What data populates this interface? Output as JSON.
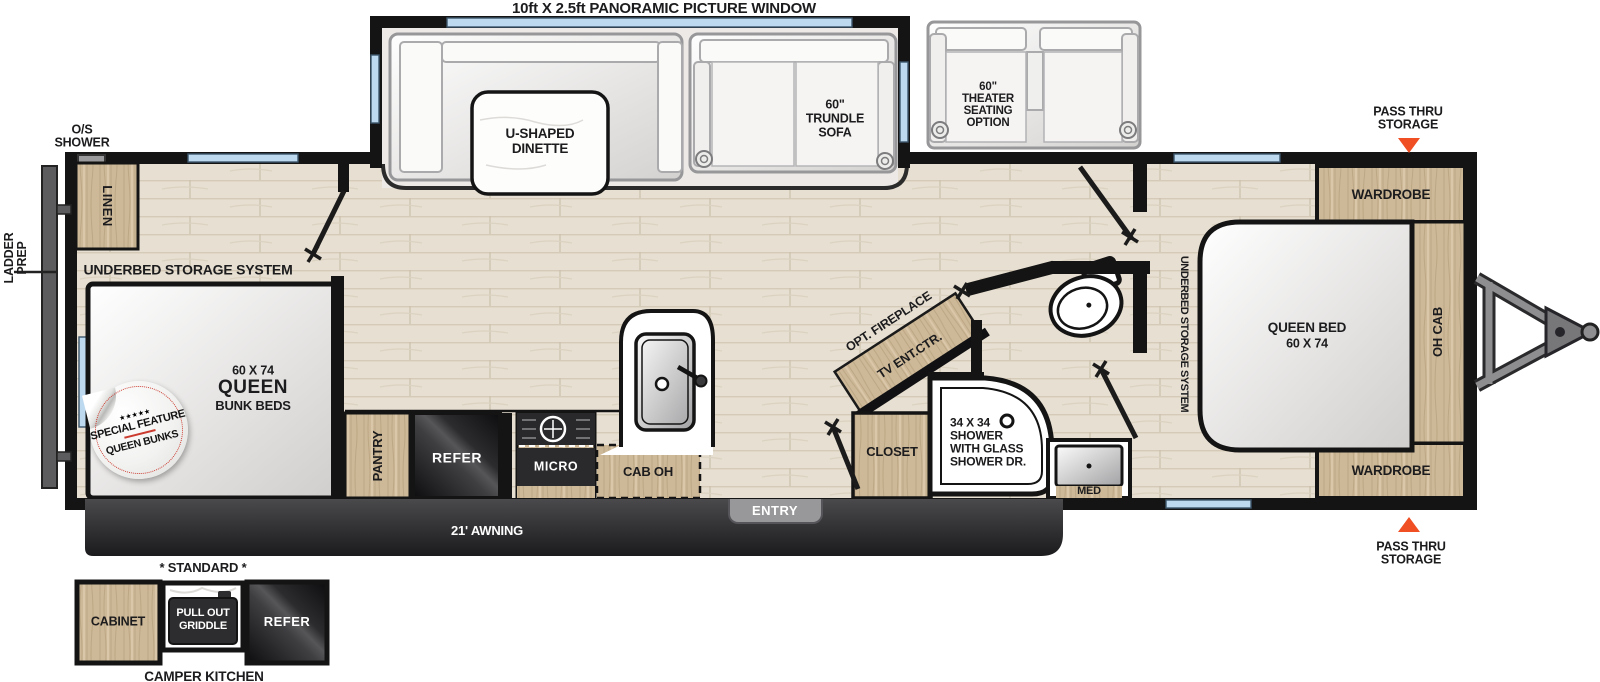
{
  "title": "10ft X 2.5ft PANORAMIC PICTURE WINDOW",
  "exterior": {
    "os_shower": {
      "line1": "O/S",
      "line2": "SHOWER"
    },
    "ladder_prep": {
      "line1": "LADDER",
      "line2": "PREP"
    },
    "pass_thru_top": {
      "line1": "PASS THRU",
      "line2": "STORAGE"
    },
    "pass_thru_bottom": {
      "line1": "PASS THRU",
      "line2": "STORAGE"
    },
    "awning": "21' AWNING",
    "entry": "ENTRY"
  },
  "slideout": {
    "dinette": {
      "line1": "U-SHAPED",
      "line2": "DINETTE"
    },
    "sofa": {
      "line1": "60\"",
      "line2": "TRUNDLE",
      "line3": "SOFA"
    }
  },
  "theater": {
    "line1": "60\"",
    "line2": "THEATER",
    "line3": "SEATING",
    "line4": "OPTION"
  },
  "bunk_room": {
    "linen": "LINEN",
    "underbed": "UNDERBED STORAGE SYSTEM",
    "size": "60 X 74",
    "name": "QUEEN",
    "type": "BUNK BEDS",
    "badge": {
      "stars": "★★★★★",
      "top": "SPECIAL FEATURE",
      "bottom": "QUEEN BUNKS"
    }
  },
  "kitchen": {
    "pantry": "PANTRY",
    "refer": "REFER",
    "micro": "MICRO",
    "cab_oh": "CAB OH"
  },
  "mid_bath": {
    "opt_fireplace": "OPT. FIREPLACE",
    "tv": "TV ENT.CTR.",
    "closet": "CLOSET",
    "shower": {
      "line1": "34 X 34",
      "line2": "SHOWER",
      "line3": "WITH GLASS",
      "line4": "SHOWER DR."
    },
    "med": "MED"
  },
  "bedroom": {
    "underbed": "UNDERBED STORAGE SYSTEM",
    "bed": {
      "line1": "QUEEN BED",
      "line2": "60 X 74"
    },
    "wardrobe_top": "WARDROBE",
    "wardrobe_bottom": "WARDROBE",
    "oh_cab": "OH CAB"
  },
  "camper_kitchen": {
    "standard": "* STANDARD *",
    "cabinet": "CABINET",
    "griddle": {
      "line1": "PULL OUT",
      "line2": "GRIDDLE"
    },
    "refer": "REFER",
    "caption": "CAMPER KITCHEN"
  },
  "colors": {
    "accent_orange": "#f04e23",
    "wall_black": "#141414",
    "window_blue": "#bcd9ef",
    "wood_tan": "#cdb897",
    "appliance_dark": "#1c1c1e",
    "badge_red": "#cc3b2f"
  }
}
